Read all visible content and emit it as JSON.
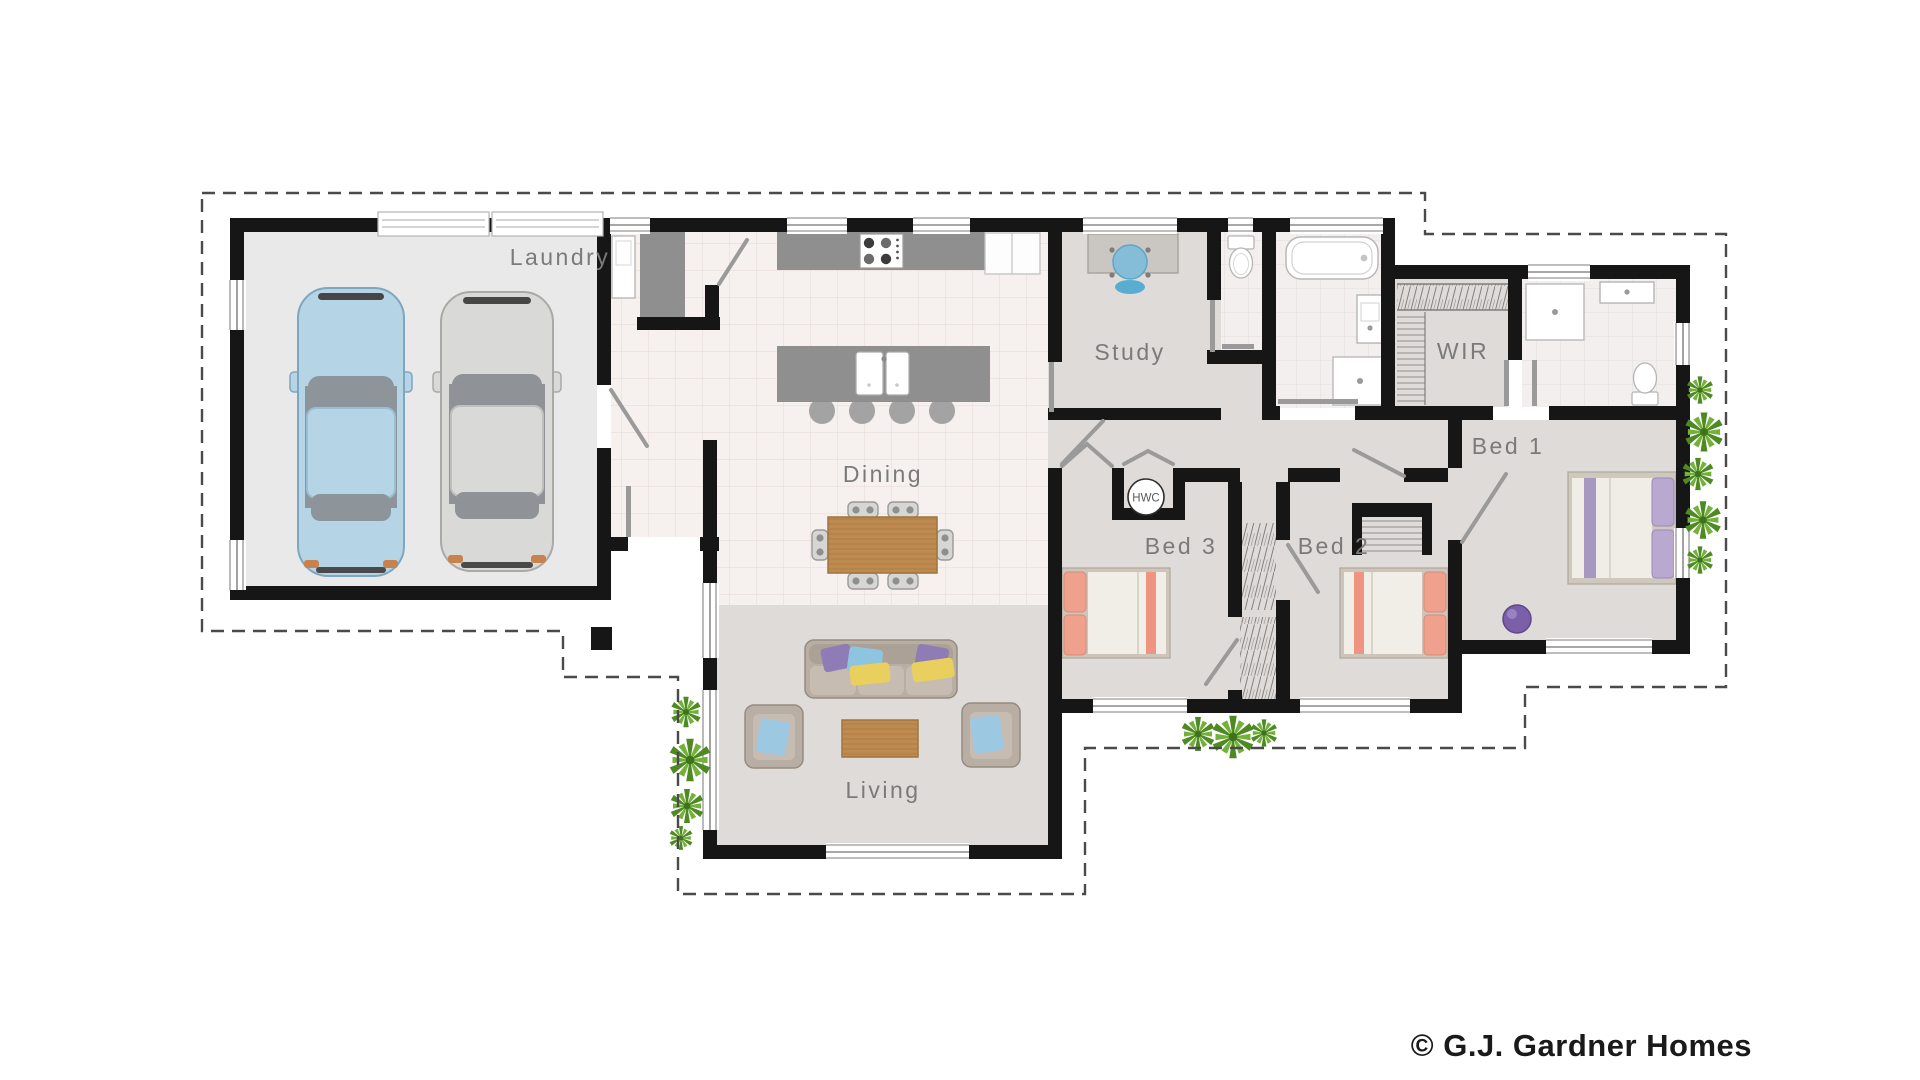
{
  "plan": {
    "labels": {
      "laundry": "Laundry",
      "dining": "Dining",
      "living": "Living",
      "study": "Study",
      "wir": "WIR",
      "bed1": "Bed 1",
      "bed2": "Bed 2",
      "bed3": "Bed 3",
      "hwc": "HWC"
    },
    "palette": {
      "wall": "#161616",
      "dashed_roofline": "#4a4a4a",
      "floor_main": "#dfdbd8",
      "floor_tile": "#f6f0ef",
      "floor_garage": "#e9e9e9",
      "label_text": "#7a7a7a",
      "wood": "#bd8a4f",
      "counter_gray": "#8f8f8f",
      "sofa": "#b9aea3",
      "pillow_purple": "#8f7bb5",
      "pillow_blue": "#8fc4e0",
      "pillow_yellow": "#e8cf5e",
      "bed_pillow_salmon": "#efa18d",
      "bed1_pillow_lavender": "#b9a8cf",
      "car_blue": "#b5d4e6",
      "car_silver": "#d9d9d7",
      "study_chair_blue": "#7fb9d6",
      "ottoman_purple": "#7b5fa8",
      "plant_green": "#66a033"
    }
  },
  "footer": {
    "copyright": "© G.J. Gardner Homes"
  }
}
